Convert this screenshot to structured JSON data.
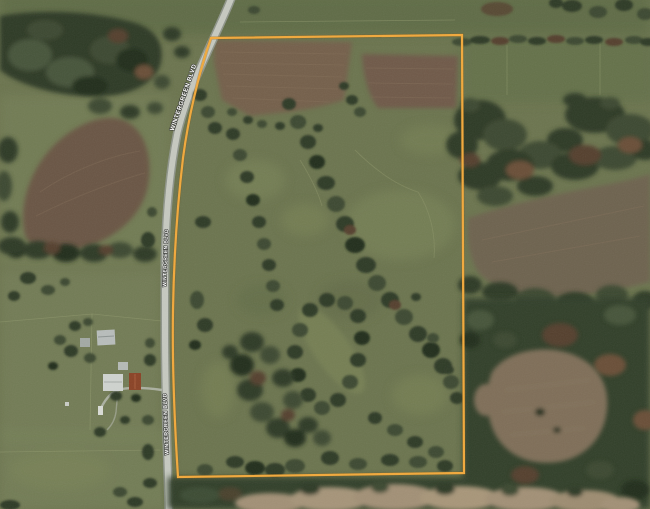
{
  "map": {
    "road": {
      "name": "WINTERGREEN BLVD",
      "label_instances": [
        "WINTERGREEN BLVD",
        "WINTERGREEN BLVD",
        "WINTERGREEN BLVD"
      ]
    },
    "parcel_boundary": {
      "stroke_color": "#F2A93B",
      "corners_px": {
        "top_left": [
          211,
          38
        ],
        "top_right": [
          462,
          35
        ],
        "bottom_right": [
          464,
          473
        ],
        "bottom_left": [
          178,
          477
        ]
      }
    },
    "palette": {
      "pasture_green": "#6C754F",
      "light_pasture": "#7E8759",
      "dark_trees": "#2E3A27",
      "autumn_trees": "#6B4F38",
      "tilled_brown": "#6F5C49",
      "tan_field": "#A29076",
      "road_surface": "#C6C9C0",
      "label_text": "#FFFFFF"
    }
  }
}
